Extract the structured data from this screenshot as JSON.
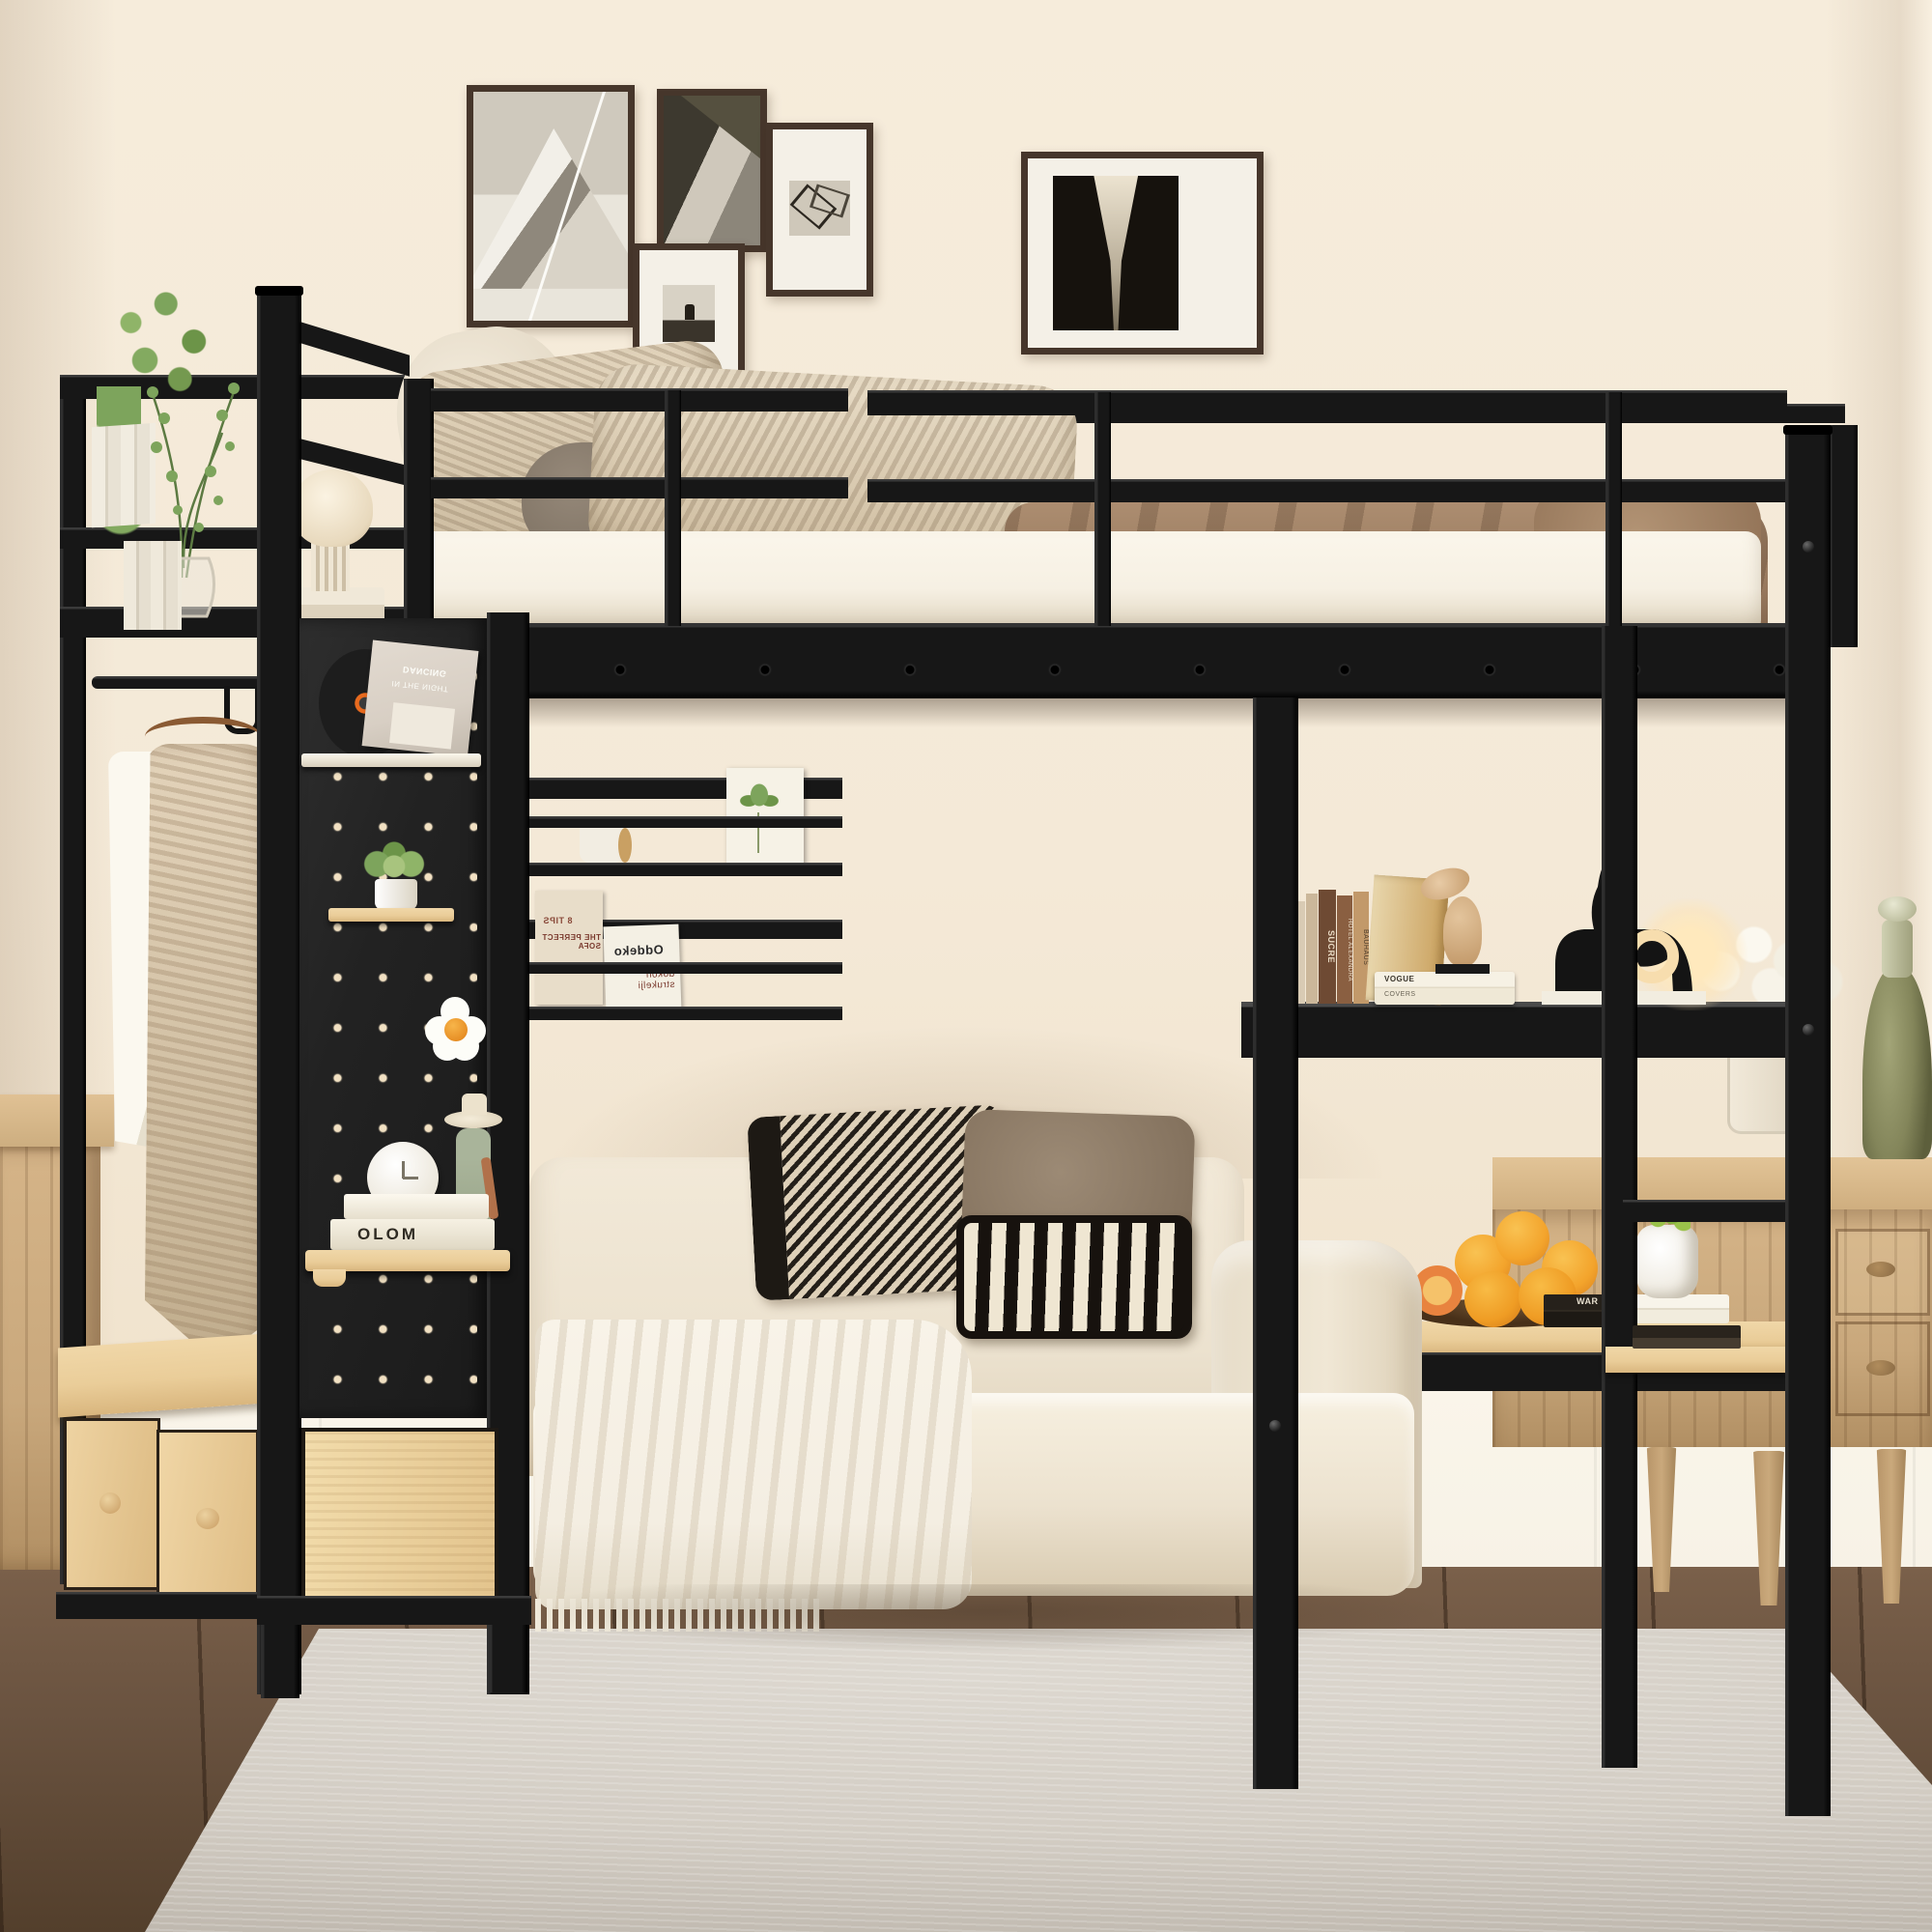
{
  "scene": {
    "type": "furniture-product-photo",
    "subject": "Black metal loft bed with pegboard wardrobe, storage bench, wall shelves, built-in desk and ladder over a cream sofa in a warm beige bedroom",
    "palette": {
      "wall": "#f4e9d7",
      "wallDeep": "#e8d9c0",
      "wainscot": "#f7f2e6",
      "floor": "#6a5340",
      "floorDark": "#533f2c",
      "rug": "#d3cdc4",
      "metal": "#171717",
      "metalHi": "#3b3b3b",
      "frame": "#46362b",
      "mat": "#f4f0e7",
      "woodLight": "#eacd99",
      "woodMid": "#c9a87c",
      "woodDeep": "#9d7c55",
      "mattress": "#f6f0e3",
      "pillowBeige": "#d9c9b0",
      "blanket": "#97785d",
      "sofa": "#ece2cf",
      "throw": "#f4eee2",
      "plant": "#7da45c",
      "orange": "#f3a42c",
      "sleeve": "#d8cfc4",
      "greenGlass": "#83855a",
      "brass": "#8a6b45"
    }
  },
  "wall_art": [
    {
      "label": "mountain-peak-photo"
    },
    {
      "label": "corridor-architecture-photo"
    },
    {
      "label": "deer-photo"
    },
    {
      "label": "abstract-triangles-photo"
    },
    {
      "label": "forest-road-photo"
    }
  ],
  "texts": {
    "vinyl_title_line1": "DANCING",
    "vinyl_title_line2": "IN THE NIGHT",
    "magazine_large_heading": "8 TIPS",
    "magazine_large_subheading": "THE PERFECT SOFA",
    "magazine_small_brand": "Oddeko",
    "magazine_small_title": "dokon strukelji",
    "book_spine_olom": "OLOM",
    "book_spine_sucre": "SUCRE",
    "book_spine_hotel": "HOTEL ALEXANDRA",
    "book_spine_bauhaus": "BAUHAUS",
    "book_stack_title": "VOGUE",
    "book_stack_subtitle": "COVERS",
    "desk_book_spine": "WAR"
  }
}
